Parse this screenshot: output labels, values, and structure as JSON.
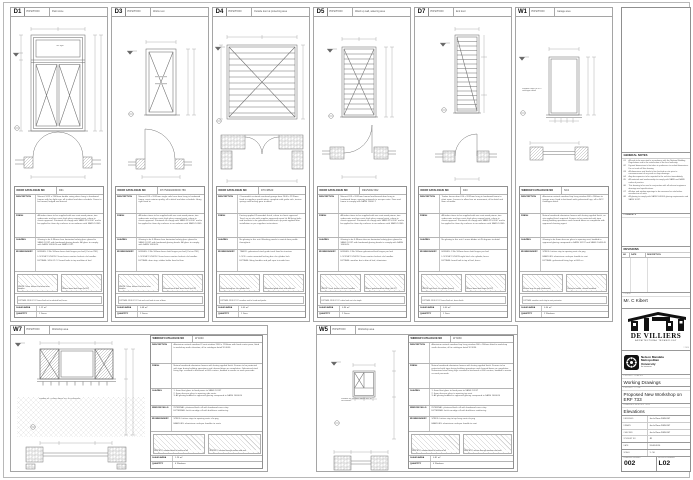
{
  "labels": {
    "position": "POSITION",
    "door_cat": "DOOR CATALOGUE NO",
    "window_cat": "WINDOW CATALOGUE NO",
    "description": "DESCRIPTION",
    "finish": "FINISH",
    "glazing": "GLAZING",
    "window_sills": "WINDOW SILLS",
    "ironmongery": "IRONMONGERY",
    "glass_area": "GLASS AREA",
    "quantity": "QUANTITY"
  },
  "door_panels": [
    {
      "id": "D1",
      "pos": "Paint store",
      "cat": "D61",
      "fanlight_label": "fan light",
      "desc": "Meranti 1613 x 2349mm double swing doors hung in hardwood frames with fan light over, all to detail and door schedule. Doors to be framed, ledged and braced.",
      "finish": "All timber items to be supplied with one coat wood primer, two undercoats and two coats high gloss enamel paint, colour to clients approval. Paintwork to comply with SABS 515-2007 and to be applied to clean dry surfaces in accordance with SANS 10305.",
      "glazing": "Glazing to be 6.38mm clear laminated safety glass glazed to SANS 10137 with hardwood glazing beads. All glass to comply with SANS 10400-N and SABS 0137.",
      "iron": [
        "HINGES: 3 No 100mm brass butt hinges per leaf (Cat no 786)",
        "LOCKSET: UNION 2 lever brass mortice lockset c/w handles",
        "EXTRAS: SDS 02 CC barrel bolts to top and btm of leaf"
      ],
      "cap1": "UNION 2 lever lockset c/w brass lever handles",
      "cap2": "100mm brass butt hinge (ref 02)",
      "extras": "EXTRAS: SDS 02 CC barrel bolt set to rebated leaf, brass",
      "ga": "1.12 m²",
      "qty": "2 Doors"
    },
    {
      "id": "D3",
      "pos": "Works rest",
      "cat": "D77/SD2020/MOD.786",
      "desc": "Meranti 813 x 2032mm single solid core door hung in hardwood frame, semi exterior quality, all to detail and door schedule. Hung right hand in.",
      "finish": "All timber items to be supplied with one coat wood primer, two undercoats and two coats high gloss enamel paint, colour to clients approval. Paintwork to comply with SABS 515-2007 and to be applied to clean dry surfaces in accordance with SANS 10305.",
      "glazing": "Glazing to be 6.38mm clear laminated safety glass glazed to SANS 10137 with hardwood glazing beads. All glass to comply with SANS 10400-N.",
      "iron": [
        "HINGES: 3 No 100mm brass butt hinges per leaf (Cat no 786)",
        "LOCKSET: UNION 2 lever brass mortice lockset c/w handles",
        "EXTRAS: door stop, rubber buffer fixed to floor"
      ],
      "cap1": "UNION 2 lever lockset c/w brass lever handles",
      "cap2": "Samson barrel bolt, brass finish (ref 02)",
      "extras": "EXTRAS: SDS 02 CC hat and coat hook to rear of door",
      "ga": "0.48 m²",
      "qty": "2 Doors"
    },
    {
      "id": "D4",
      "pos": "Outside door at protecting area",
      "cat": "D79 38620",
      "desc": "Chromadek sectional overhead garage door 2440 x 2135mm fixed to suppliers specification, complete with guide rails, torsion springs and locking gear to detail.",
      "finish": "Factory applied Chromadek finish, colour to clients approval. Touch up on site with supplier approved repair kit. All fixing bolts and brackets to be galvanised and touch up paint applied after installation as per suppliers instructions.",
      "glazing": "No glazing to this unit. Blanking panels to match door profile throughout.",
      "iron": [
        "TRACK: galvanised steel guide track fixed to structure",
        "LOCK: centre mounted locking bar c/w cylinder lock",
        "EXTRAS: lifting handles and pull rope to inside face"
      ],
      "cap1": "Centre locking bar c/w cylinder lock",
      "cap2": "Galvanised guide track and roller set",
      "extras": "EXTRAS: SDS 02 CC weather seal to head and jambs",
      "ga": "0.00 m²",
      "qty": "1 Door"
    },
    {
      "id": "D5",
      "pos": "Wash up wall, watering area",
      "cat": "D90/SD02 802",
      "desc": "Meranti 813 x 2032mm framed and braced door hung in hardwood frame, opening outwards to escape route. Door and frame to comply with SANS 10400-T.",
      "finish": "All timber items to be supplied with one coat wood primer, two undercoats and two coats high gloss enamel paint, colour to clients approval. Paintwork to comply with SABS 515-2007 and to be applied to clean dry surfaces in accordance with SANS 10305.",
      "glazing": "Glazing to be 6.38mm obscure laminated safety glass glazed to SANS 10137 with hardwood glazing beads to comply with SANS 10400-N.",
      "iron": [
        "HINGES: 3 No 100mm galvanised butt hinges per leaf",
        "LOCKSET: UNION 2 lever mortice lockset c/w handles",
        "EXTRAS: weather bar to btm of leaf, aluminium"
      ],
      "cap1": "UNION 2 lever lockset c/w lever handles",
      "cap2": "100mm galvanised butt hinge (ref 02)",
      "extras": "EXTRAS: SDS 02 CC cabin hook set c/w staple",
      "ga": "0.96 m²",
      "qty": "2 Doors"
    },
    {
      "id": "D7",
      "pos": "End door",
      "cat": "D40",
      "desc": "Timber louvre door 610 x 2032mm hung in hardwood frame to plant room. Louvres to allow free air movement, all to detail and door schedule.",
      "finish": "All timber items to be supplied with one coat wood primer, two undercoats and two coats high gloss enamel paint, colour to clients approval. Paintwork to comply with SABS 515-2007 and to be applied to clean dry surfaces in accordance with SANS 10305.",
      "glazing": "No glazing to this unit. Louvre blades at 45 degrees to detail.",
      "iron": [
        "HINGES: 3 No 100mm brass butt hinges per leaf",
        "LOCKSET: UNION night latch c/w cylinder, brass",
        "EXTRAS: barrel bolt to top of leaf, brass"
      ],
      "cap1": "UNION night latch c/w cylinder (brass)",
      "cap2": "100mm brass butt hinge (ref 02)",
      "extras": "EXTRAS: SDS 02 CC barrel bolt set, brass finish",
      "ga": "0.00 m²",
      "qty": "1 Door"
    },
    {
      "id": "W1",
      "pos": "Garage area",
      "cat": "NC2",
      "note": "Window frame to NC2 catalogue detail",
      "desc": "Aluminium natural anodised top hung window 600 x 900mm to garage area, fixed to brickwork with galvanised lugs, all to NC2 catalogue detail.",
      "finish": "Natural anodised aluminium frames with factory applied finish, no site applied finish required. Frames to be protected with tape during building operations and cleaned down on completion with approved cleaning agent.",
      "glazing": "Glazing to be 4mm obscure glass to opening vent, bedded in approved glazing compound to SANS 10137 and SANS 10400-N.",
      "iron": [
        "STAYS: friction stay to opening vent c/w peg",
        "HANDLES: aluminium cockspur handle to vent",
        "EXTRAS: galvanised fixing lugs at 600 crs"
      ],
      "cap1": "Friction stay c/w peg (aluminium)",
      "cap2": "Cockspur handle, natural anodised",
      "extras": "EXTRAS: weather seal strip to vent perimeter",
      "ga": "0.54 m²",
      "qty": "2 Windows"
    }
  ],
  "window_panels": [
    {
      "id": "W7",
      "pos": "Workshop area",
      "cat": "W 4040",
      "note": "Window sill 1700mm above FFL to coursework",
      "desc": "Aluminium natural anodised 3 vent window 2400 x 1200mm with fixed centre pane, fitted to workshop north elevation, all to catalogue detail W 4040.",
      "finish": "Natural anodised aluminium frames with factory applied finish. Frames to be protected with tape during building operations and cleaned down on completion. Galvanised steel fixing lugs screwed to brickwork at 600 centres, bedded in mortar as work proceeds.",
      "glz": [
        "1.  4mm float glass to fixed panes to SANS 10137",
        "2.  4mm obscure glass to opening side vents",
        "3.  All glazing bedded in approved glazing compound to SANS 10400-N"
      ],
      "sills": [
        "INTERNAL: plastered brick sill with hardwood cover strip",
        "EXTERNAL: brick-on-edge sill with brickforce reinforcing"
      ],
      "iron": [
        "STAYS: friction stays to opening vents c/w peg",
        "HANDLES: aluminium cockspur handles to vents"
      ],
      "cap1": "WISPECO window detail at head and sill",
      "cap2": "WISPECO section through mullion and vent",
      "ga": "1.26 m²",
      "qty": "4 Windows"
    },
    {
      "id": "W5",
      "pos": "Workshop area",
      "cat": "W 3030",
      "note": "Window sill 1500mm above FFL to coursework",
      "desc": "Aluminium natural anodised top hung window 900 x 900mm fitted to workshop south elevation, all to catalogue detail W 3030.",
      "finish": "Natural anodised aluminium frames with factory applied finish. Frames to be protected with tape during building operations and cleaned down on completion. Galvanised steel fixing lugs screwed to brickwork at 600 centres, bedded in mortar as work proceeds.",
      "glz": [
        "1.  4mm float glass to fixed pane to SANS 10137",
        "2.  4mm obscure glass to opening top vent",
        "3.  All glazing bedded in approved glazing compound to SANS 10400-N"
      ],
      "sills": [
        "INTERNAL: plastered brick sill with hardwood cover strip",
        "EXTERNAL: brick-on-edge sill with brickforce reinforcing"
      ],
      "iron": [
        "STAYS: friction stay to top hung vent c/w peg",
        "HANDLES: aluminium cockspur handle to vent"
      ],
      "cap1": "WISPECO window detail at head and sill",
      "cap2": "WISPECO section through transom and vent",
      "ga": "0.81 m²",
      "qty": "4 Windows"
    }
  ],
  "notes": {
    "title": "GENERAL NOTES",
    "items": [
      {
        "no": "01",
        "text": "All work to be executed in accordance with the National Building Regulations and to the satisfaction of the local authority."
      },
      {
        "no": "02",
        "text": "Figured dimensions to be taken in preference to scaled dimensions. Do not scale off this drawing."
      },
      {
        "no": "03",
        "text": "All dimensions and levels to be checked on site prior to commencement of any work or shop drawings."
      },
      {
        "no": "04",
        "text": "Any discrepancies to be reported to the architect immediately."
      },
      {
        "no": "05",
        "text": "All materials and workmanship to comply with SABS and SANS codes of practice."
      },
      {
        "no": "06",
        "text": "This drawing to be read in conjunction with all relevant engineers drawings and specifications."
      },
      {
        "no": "07",
        "text": "All door and window openings to be measured on site before manufacture of units."
      },
      {
        "no": "08",
        "text": "All glazing to comply with SANS 10400-N glazing requirements and SANS 10137."
      }
    ],
    "comments_label": "COMMENTS"
  },
  "revisions": {
    "title": "REVISIONS",
    "col_no": "NO",
    "col_date": "DATE",
    "col_desc": "DESCRIPTION"
  },
  "title_block": {
    "client_label": "CLIENT",
    "client": "Mr. C Kibert",
    "firm_name": "DE VILLIERS",
    "firm_sub": "ARCHITECTURAL TECHNOLOGY",
    "firm_copy": "© 2010",
    "uni_line1": "Nelson Mandela",
    "uni_line2": "Metropolitan",
    "uni_line3": "University",
    "uni_tag": "for tomorrow",
    "status_label": "PROJECT STATUS",
    "status": "Working Drawings",
    "project_label": "PROJECT TITLE",
    "project": "Proposed New Workshop on ERF 733",
    "ddesc_label": "DRAWING DESCRIPTION",
    "ddesc": "Elevations",
    "signoff": [
      {
        "label": "DESIGNED",
        "value": "Jac le Roux  20810147"
      },
      {
        "label": "DRAWN",
        "value": "Jac le Roux  20810147"
      },
      {
        "label": "CHECKED",
        "value": "Jac le Roux  20810147"
      },
      {
        "label": "STUDENT NO",
        "value": "JR"
      }
    ],
    "date_label": "DATE",
    "date": "31-08-2010",
    "scale_label": "SCALE",
    "scale": "1 : 50",
    "num_label": "DRAWING NUMBER",
    "number": "002",
    "rev_label": "REVISION NUMBER",
    "revision": "L02"
  }
}
